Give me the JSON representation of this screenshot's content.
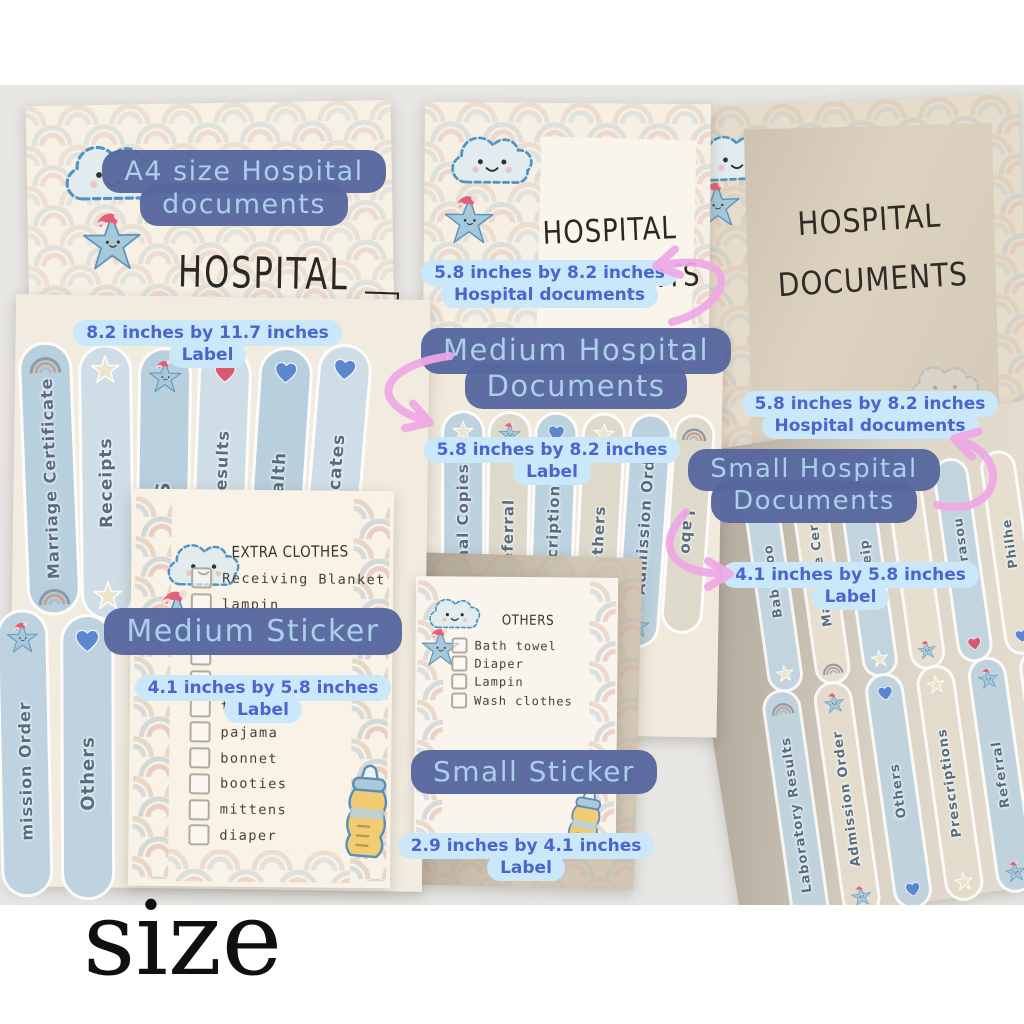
{
  "caption": "size",
  "annotations": {
    "a4_doc": {
      "line1": "A4 size Hospital",
      "line2": "documents"
    },
    "a4_size": {
      "line1": "8.2 inches by 11.7 inches",
      "line2": "Label"
    },
    "medium_doc_size": {
      "line1": "5.8 inches by 8.2 inches",
      "line2": "Hospital documents"
    },
    "medium_doc": {
      "line1": "Medium Hospital",
      "line2": "Documents"
    },
    "medium_label_size": {
      "line1": "5.8 inches by 8.2 inches",
      "line2": "Label"
    },
    "small_doc_size": {
      "line1": "5.8 inches by 8.2 inches",
      "line2": "Hospital documents"
    },
    "small_doc": {
      "line1": "Small Hospital",
      "line2": "Documents"
    },
    "small_label_size": {
      "line1": "4.1 inches by 5.8 inches",
      "line2": "Label"
    },
    "medium_sticker": "Medium Sticker",
    "medium_sticker_size": {
      "line1": "4.1 inches by 5.8 inches",
      "line2": "Label"
    },
    "small_sticker": "Small Sticker",
    "small_sticker_size": {
      "line1": "2.9 inches by 4.1 inches",
      "line2": "Label"
    }
  },
  "documents": {
    "a4_title": "HOSPITAL",
    "medium_title1": "HOSPITAL",
    "medium_title2": "DOCUMENTS",
    "small_title1": "HOSPITAL",
    "small_title2": "DOCUMENTS",
    "name_of_mother": "Name of Mother"
  },
  "labels": {
    "a4_row1": [
      "Marriage Certificate",
      "Receipts",
      "CAS",
      "sound Results",
      "hilhealth",
      "Certificates"
    ],
    "a4_row2": [
      "mission Order",
      "Others"
    ],
    "medium": [
      "Original Copies",
      "Referral",
      "Prescriptions",
      "Others",
      "Admission Order",
      "Labo"
    ],
    "small_row1": [
      "Baby Boo",
      "Marriage Cer",
      "Receip",
      "",
      "Ultrasou",
      "Philhe",
      "Birth Cert"
    ],
    "small_row2": [
      "Laboratory Results",
      "Admission Order",
      "Others",
      "Prescriptions",
      "Referral",
      "Original Copies",
      "Valid ID's"
    ]
  },
  "checklists": {
    "extra_clothes": {
      "title": "EXTRA CLOTHES",
      "items": [
        "Receiving Blanket",
        "lampin",
        "",
        "",
        "short sleeves",
        "tie",
        "pajama",
        "bonnet",
        "booties",
        "mittens",
        "diaper"
      ]
    },
    "others": {
      "title": "OTHERS",
      "items": [
        "Bath towel",
        "Diaper",
        "Lampin",
        "Wash clothes"
      ]
    }
  },
  "colors": {
    "annotation_box": "#56679e",
    "annotation_text": "#a9cfea",
    "badge_bg": "#cbe7fa",
    "badge_text": "#4a65cc",
    "arrow_pink": "#f0a8e6"
  }
}
